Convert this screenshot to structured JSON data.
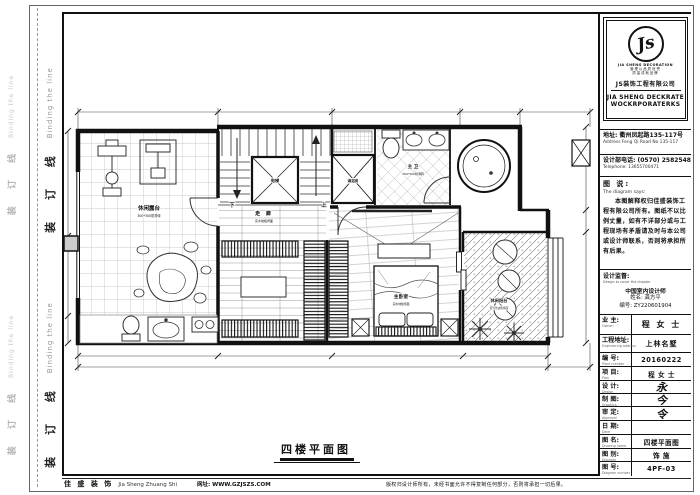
{
  "sheet": {
    "binding": {
      "cn": "装 订 线",
      "en": "Binding the line"
    },
    "plan_title": "四楼平面图",
    "footer": {
      "brand_cn": "佳 盛 装 饰",
      "brand_en": "Jia Sheng Zhuang Shi",
      "site": "网址: WWW.GZJSZS.COM",
      "copyright": "版权归设计师所有，未经书面允许不得复制任何部分，否则将承担一切后果。"
    }
  },
  "titleblock": {
    "logo": {
      "monogram": "Js",
      "brand_small": "JIA SHENG DECORATION",
      "tag1": "管理以品质信誉",
      "tag2": "质量成就品牌",
      "company": "JS装饰工程有限公司",
      "brand_line1": "JIA SHENG DECKRATE",
      "brand_line2": "WOCKRPORATERKS"
    },
    "address_cn": "地址: 衢州凤起路135-117号",
    "address_en": "Address Feng Qi Road No 135-117",
    "tel_cn": "设计部电话: (0570) 2582548",
    "tel_en": "Telephone: 13655700471",
    "notes": {
      "cn": "图 说:",
      "en": "The diagram says:",
      "body": "本图解释权归佳盛装饰工程有限公司所有。图纸不以比例丈量，如有不详部分或与工程现场有矛盾请及时与本公司或设计师联系，否则将承担所有后果。"
    },
    "supervision": {
      "cn": "设计监督:",
      "en": "Design to cover the chapter",
      "line1": "中国室内设计师",
      "line2": "姓名: 龚方平",
      "line3": "编号: ZY220601904"
    },
    "owner": {
      "cn": "业 主:",
      "en": "Owner:",
      "value": "程 女 士"
    },
    "project": {
      "cn": "工程地址:",
      "en": "Engineering address",
      "value": "上林名墅"
    },
    "rows": [
      {
        "cn": "编 号:",
        "en": "Plant number",
        "value": "20160222"
      },
      {
        "cn": "项 目:",
        "en": "Plan",
        "value": "程 女 士"
      },
      {
        "cn": "设 计:",
        "en": "Design",
        "value": "永"
      },
      {
        "cn": "制 图:",
        "en": "Graphics",
        "value": "今"
      },
      {
        "cn": "审 定:",
        "en": "Approval",
        "value": "令"
      },
      {
        "cn": "日 期:",
        "en": "Date",
        "value": ""
      },
      {
        "cn": "图 名:",
        "en": "Drawing name",
        "value": "四楼平面图"
      },
      {
        "cn": "图 别:",
        "en": "Diagram",
        "value": "饰 施"
      },
      {
        "cn": "图 号:",
        "en": "Diagram number",
        "value": "4PF-03"
      }
    ]
  },
  "plan": {
    "rooms": {
      "terrace": {
        "name": "休闲露台",
        "sub": "300*300防滑砖"
      },
      "corridor": {
        "name": "走 廊",
        "sub": "实木地板饰面"
      },
      "elevator": "电梯",
      "down": "下",
      "up": "上",
      "shower": "淋浴房",
      "bath": {
        "name": "主 卫",
        "sub": "300*300防滑砖"
      },
      "bedroom": {
        "name": "主卧室",
        "sub": "实木地板饰面"
      },
      "balcony": {
        "name": "休闲阳台",
        "sub": "亚光仿古砖饰面"
      }
    }
  }
}
